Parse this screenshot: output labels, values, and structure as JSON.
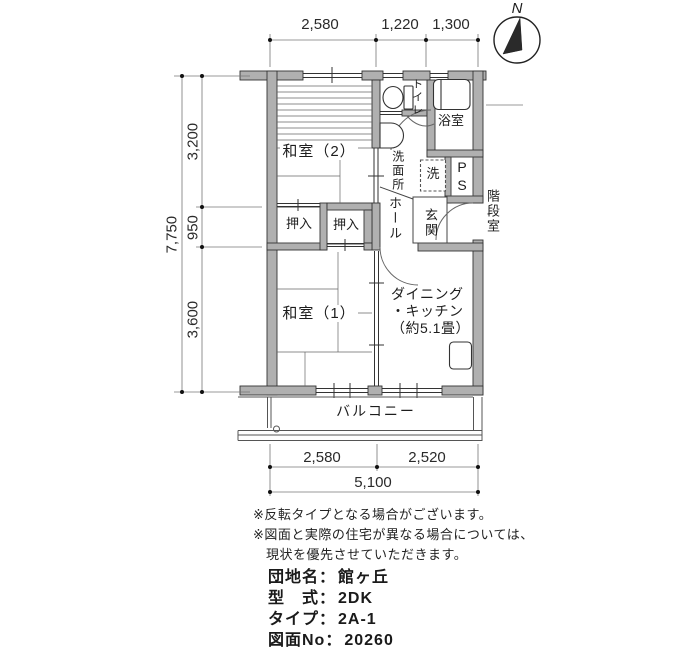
{
  "compass": {
    "north_label": "N"
  },
  "rooms": {
    "washitsu2": "和室（2）",
    "washitsu1": "和室（1）",
    "toilet": "トイレ",
    "bath": "浴室",
    "washroom": "洗面所",
    "washer": "洗",
    "pipe_space": "PS",
    "hall": "ホール",
    "entrance": "玄関",
    "closet1": "押入",
    "closet2": "押入",
    "dk_line1": "ダイニング",
    "dk_line2": "・キッチン",
    "dk_line3": "（約5.1畳）",
    "balcony": "バルコニー",
    "stairwell": "階段室"
  },
  "dimensions": {
    "top": [
      "2,580",
      "1,220",
      "1,300"
    ],
    "left_total": "7,750",
    "left_segments": [
      "3,200",
      "950",
      "3,600"
    ],
    "bottom_segments": [
      "2,580",
      "2,520"
    ],
    "bottom_total": "5,100"
  },
  "notes": [
    "※反転タイプとなる場合がございます。",
    "※図面と実際の住宅が異なる場合については、",
    "現状を優先させていただきます。"
  ],
  "info": {
    "rows": [
      {
        "label": "団地名：",
        "value": "館ヶ丘"
      },
      {
        "label": "型　式：",
        "value": "2DK"
      },
      {
        "label": "タイプ：",
        "value": "2A-1"
      },
      {
        "label": "図面No：",
        "value": "20260"
      }
    ]
  }
}
